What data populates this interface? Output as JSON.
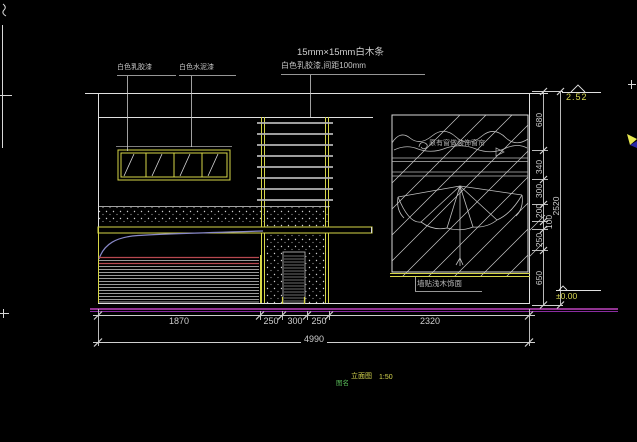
{
  "drawing": {
    "annotations": {
      "paint_left": "白色乳胶漆",
      "paint_right": "白色水泥漆",
      "wood_strip_line1": "15mm×15mm白木条",
      "wood_strip_line2": "白色乳胶漆,间距100mm",
      "window_note": "原有窗做装饰窗帘",
      "wall_note": "墙贴浅木饰面"
    },
    "dims_bottom": {
      "segments": [
        "1870",
        "250",
        "300",
        "250",
        "2320"
      ],
      "total": "4990"
    },
    "dims_right": {
      "segments": [
        "680",
        "340",
        "300",
        "200",
        "100",
        "250",
        "650"
      ],
      "total": "2520"
    },
    "elevations": {
      "top": "2.52",
      "bottom": "±0.00"
    },
    "title": {
      "name": "立面图",
      "scale": "1:50",
      "tag": "图名"
    },
    "colors": {
      "line_white": "#e0e0e0",
      "line_yellow": "#d6d648",
      "floor_magenta": "#c044c0",
      "glass_red": "#b84850",
      "elev_yellow": "#d8d850",
      "title_green": "#58b858",
      "curve_blue": "#8888c8"
    }
  }
}
